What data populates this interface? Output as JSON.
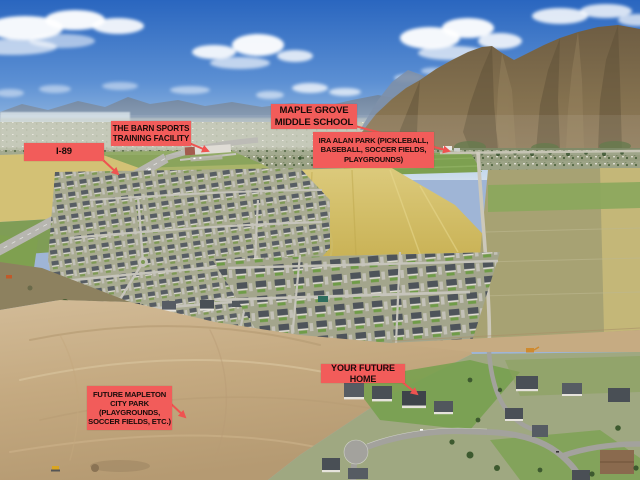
{
  "image_type": "aerial-drone-real-estate-photo",
  "colors": {
    "label_background": "#f25c5a",
    "label_text": "#190c0a",
    "pointer_line": "#ef5350",
    "sky_top": "#2a66bf",
    "sky_horizon": "#cfdeed",
    "mountain": "#7b6a4e",
    "dirt": "#c9ae88"
  },
  "annotations": {
    "i89": {
      "label": "I-89"
    },
    "barn": {
      "label": "THE BARN SPORTS\nTRAINING FACILITY"
    },
    "school": {
      "label": "MAPLE GROVE\nMIDDLE SCHOOL"
    },
    "park": {
      "label": "IRA ALAN PARK (PICKLEBALL,\nBASEBALL, SOCCER FIELDS,\nPLAYGROUNDS)"
    },
    "home": {
      "label": "YOUR FUTURE HOME"
    },
    "future_park": {
      "label": "FUTURE MAPLETON\nCITY PARK\n(PLAYGROUNDS,\nSOCCER FIELDS, ETC.)"
    }
  }
}
